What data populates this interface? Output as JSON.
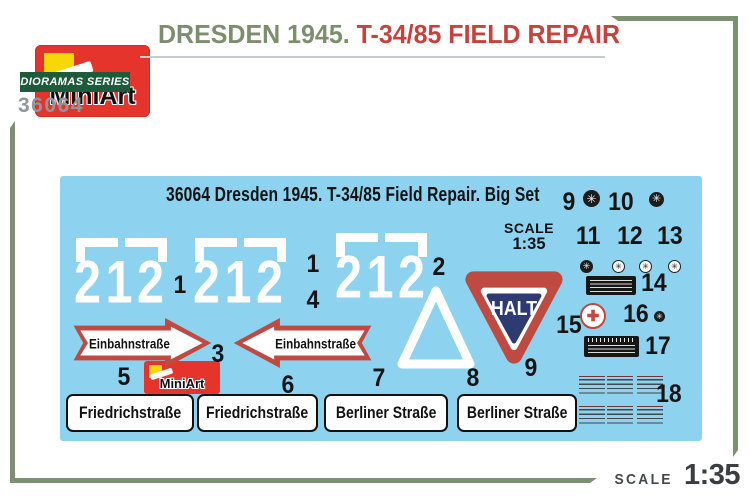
{
  "header": {
    "brand": "MiniArt",
    "series_badge": "DIORAMAS SERIES",
    "kit_number": "36064",
    "title": {
      "part1": "DRESDEN 1945.",
      "part2": " T-34/85 FIELD REPAIR"
    }
  },
  "sheet": {
    "brand": "MiniArt",
    "title": "36064 Dresden 1945. T-34/85 Field Repair. Big Set",
    "scale_label": "SCALE",
    "scale_value": "1:35",
    "stencil_number": "212",
    "halt_text": "HALT",
    "arrow_text": "Einbahnstraße",
    "street_signs": [
      "Friedrichstraße",
      "Friedrichstraße",
      "Berliner Straße",
      "Berliner Straße"
    ],
    "markers": [
      "1",
      "1",
      "4",
      "2",
      "3",
      "5",
      "6",
      "7",
      "8",
      "9",
      "15",
      "9",
      "10",
      "11",
      "12",
      "13",
      "14",
      "16",
      "17",
      "18"
    ]
  },
  "footer": {
    "scale_label": "SCALE",
    "scale_value": "1:35"
  },
  "icons": {
    "gauge_glyph": "✳",
    "cross_glyph": "✚"
  },
  "colors": {
    "sheet_blue": "#8dd2ef",
    "brand_red": "#e5342c",
    "brand_yellow": "#f8d70a",
    "series_green": "#1d5c3a",
    "title_green": "#7b8f6d",
    "title_red": "#c8423b",
    "sign_red": "#bf4a41",
    "halt_blue": "#2e3a72",
    "frame_green": "#7b9171",
    "kit_number_gray": "#8f979c",
    "scale_dark": "#3a3e41"
  }
}
